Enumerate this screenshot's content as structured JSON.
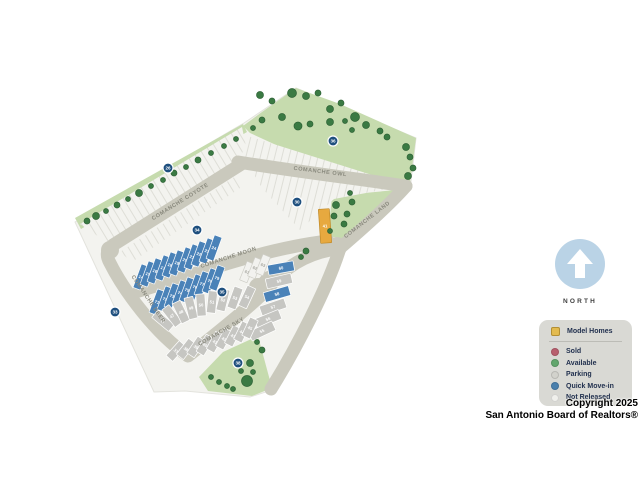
{
  "north": {
    "label": "NORTH"
  },
  "copyright": {
    "line1": "Copyright 2025",
    "line2": "San Antonio Board of Realtors®"
  },
  "legend": {
    "items": [
      {
        "label": "Model Homes",
        "color": "#e3bb4f",
        "shape": "square"
      },
      {
        "label": "Sold",
        "color": "#b85f6e",
        "shape": "circle"
      },
      {
        "label": "Available",
        "color": "#62a66d",
        "shape": "circle"
      },
      {
        "label": "Parking",
        "color": "#d2d2cc",
        "shape": "circle"
      },
      {
        "label": "Quick Move-in",
        "color": "#4a80ad",
        "shape": "circle"
      },
      {
        "label": "Not Released",
        "color": "#f0f0ec",
        "shape": "circle"
      }
    ]
  },
  "map": {
    "road_labels": [
      {
        "text": "COMANCHE OWL",
        "x": 320,
        "y": 173,
        "rot": 7
      },
      {
        "text": "COMANCHE COYOTE",
        "x": 181,
        "y": 203,
        "rot": -32
      },
      {
        "text": "COMANCHE LAND",
        "x": 368,
        "y": 221,
        "rot": -38
      },
      {
        "text": "COMANCHE MOON",
        "x": 229,
        "y": 259,
        "rot": -18
      },
      {
        "text": "COMANCHE SKY",
        "x": 222,
        "y": 333,
        "rot": -30
      },
      {
        "text": "COMANCHE DEER",
        "x": 147,
        "y": 300,
        "rot": 56
      }
    ],
    "lot_colors": {
      "quick": {
        "fill": "#4a82b8",
        "text": "#ffffff",
        "stroke": "#ffffff"
      },
      "gray": {
        "fill": "#c6c6c2",
        "text": "#ffffff",
        "stroke": "#ffffff"
      },
      "white": {
        "fill": "#f2f2ef",
        "text": "#a8a8a2",
        "stroke": "#cfcfc8"
      },
      "model": {
        "fill": "#e7a93f",
        "text": "#ffffff",
        "stroke": "#c08a28"
      }
    },
    "marker_color": "#1e4f7e",
    "tree_color": "#3a7a43",
    "tree_edge": "#2e6236",
    "lots": [
      {
        "n": "14",
        "x": 141,
        "y": 277,
        "w": 8,
        "h": 25,
        "rot": 20,
        "status": "quick"
      },
      {
        "n": "15",
        "x": 148,
        "y": 274,
        "w": 8,
        "h": 25,
        "rot": 20,
        "status": "quick"
      },
      {
        "n": "16",
        "x": 155,
        "y": 271,
        "w": 8,
        "h": 25,
        "rot": 20,
        "status": "quick"
      },
      {
        "n": "17",
        "x": 163,
        "y": 268,
        "w": 8,
        "h": 25,
        "rot": 20,
        "status": "quick"
      },
      {
        "n": "18",
        "x": 170,
        "y": 265,
        "w": 8,
        "h": 25,
        "rot": 20,
        "status": "quick"
      },
      {
        "n": "19",
        "x": 177,
        "y": 263,
        "w": 8,
        "h": 25,
        "rot": 20,
        "status": "quick"
      },
      {
        "n": "20",
        "x": 185,
        "y": 260,
        "w": 8,
        "h": 25,
        "rot": 20,
        "status": "quick"
      },
      {
        "n": "21",
        "x": 192,
        "y": 257,
        "w": 8,
        "h": 25,
        "rot": 20,
        "status": "quick"
      },
      {
        "n": "22",
        "x": 199,
        "y": 254,
        "w": 8,
        "h": 25,
        "rot": 20,
        "status": "quick"
      },
      {
        "n": "23",
        "x": 207,
        "y": 251,
        "w": 8,
        "h": 25,
        "rot": 20,
        "status": "quick"
      },
      {
        "n": "24",
        "x": 214,
        "y": 248,
        "w": 8,
        "h": 25,
        "rot": 20,
        "status": "quick"
      },
      {
        "n": "71",
        "x": 157,
        "y": 302,
        "w": 8,
        "h": 25,
        "rot": 20,
        "status": "quick"
      },
      {
        "n": "72",
        "x": 165,
        "y": 299,
        "w": 8,
        "h": 25,
        "rot": 20,
        "status": "quick"
      },
      {
        "n": "73",
        "x": 172,
        "y": 296,
        "w": 8,
        "h": 25,
        "rot": 20,
        "status": "quick"
      },
      {
        "n": "74",
        "x": 180,
        "y": 293,
        "w": 8,
        "h": 25,
        "rot": 20,
        "status": "quick"
      },
      {
        "n": "75",
        "x": 187,
        "y": 290,
        "w": 8,
        "h": 25,
        "rot": 20,
        "status": "quick"
      },
      {
        "n": "76",
        "x": 195,
        "y": 287,
        "w": 8,
        "h": 25,
        "rot": 20,
        "status": "quick"
      },
      {
        "n": "77",
        "x": 202,
        "y": 284,
        "w": 8,
        "h": 25,
        "rot": 20,
        "status": "quick"
      },
      {
        "n": "78",
        "x": 210,
        "y": 281,
        "w": 8,
        "h": 25,
        "rot": 20,
        "status": "quick"
      },
      {
        "n": "79",
        "x": 217,
        "y": 278,
        "w": 8,
        "h": 25,
        "rot": 20,
        "status": "quick"
      },
      {
        "n": "61",
        "x": 247,
        "y": 272,
        "w": 8,
        "h": 20,
        "rot": 22,
        "status": "white"
      },
      {
        "n": "62",
        "x": 255,
        "y": 268,
        "w": 8,
        "h": 20,
        "rot": 22,
        "status": "white"
      },
      {
        "n": "63",
        "x": 263,
        "y": 265,
        "w": 8,
        "h": 20,
        "rot": 22,
        "status": "white"
      },
      {
        "n": "60",
        "x": 281,
        "y": 268,
        "w": 26,
        "h": 10,
        "rot": -10,
        "status": "quick"
      },
      {
        "n": "59",
        "x": 279,
        "y": 281,
        "w": 26,
        "h": 10,
        "rot": -13,
        "status": "gray"
      },
      {
        "n": "58",
        "x": 277,
        "y": 294,
        "w": 26,
        "h": 10,
        "rot": -16,
        "status": "quick"
      },
      {
        "n": "57",
        "x": 273,
        "y": 307,
        "w": 26,
        "h": 10,
        "rot": -19,
        "status": "gray"
      },
      {
        "n": "56",
        "x": 268,
        "y": 319,
        "w": 26,
        "h": 10,
        "rot": -22,
        "status": "gray"
      },
      {
        "n": "55",
        "x": 262,
        "y": 331,
        "w": 26,
        "h": 10,
        "rot": -25,
        "status": "gray"
      },
      {
        "n": "46",
        "x": 163,
        "y": 321,
        "w": 9,
        "h": 22,
        "rot": -50,
        "status": "gray"
      },
      {
        "n": "47",
        "x": 172,
        "y": 316,
        "w": 9,
        "h": 22,
        "rot": -38,
        "status": "gray"
      },
      {
        "n": "48",
        "x": 181,
        "y": 312,
        "w": 9,
        "h": 22,
        "rot": -26,
        "status": "gray"
      },
      {
        "n": "49",
        "x": 191,
        "y": 308,
        "w": 9,
        "h": 22,
        "rot": -14,
        "status": "gray"
      },
      {
        "n": "50",
        "x": 201,
        "y": 305,
        "w": 9,
        "h": 22,
        "rot": -4,
        "status": "gray"
      },
      {
        "n": "51",
        "x": 212,
        "y": 302,
        "w": 9,
        "h": 22,
        "rot": 6,
        "status": "gray"
      },
      {
        "n": "52",
        "x": 223,
        "y": 300,
        "w": 9,
        "h": 22,
        "rot": 14,
        "status": "gray"
      },
      {
        "n": "53",
        "x": 235,
        "y": 298,
        "w": 9,
        "h": 22,
        "rot": 20,
        "status": "gray"
      },
      {
        "n": "54",
        "x": 247,
        "y": 297,
        "w": 9,
        "h": 22,
        "rot": 25,
        "status": "gray"
      },
      {
        "n": "37",
        "x": 176,
        "y": 351,
        "w": 9,
        "h": 20,
        "rot": 42,
        "status": "gray"
      },
      {
        "n": "38",
        "x": 186,
        "y": 349,
        "w": 9,
        "h": 20,
        "rot": 38,
        "status": "gray"
      },
      {
        "n": "39",
        "x": 196,
        "y": 347,
        "w": 9,
        "h": 20,
        "rot": 34,
        "status": "gray"
      },
      {
        "n": "40",
        "x": 205,
        "y": 345,
        "w": 9,
        "h": 20,
        "rot": 31,
        "status": "gray"
      },
      {
        "n": "41",
        "x": 215,
        "y": 342,
        "w": 9,
        "h": 20,
        "rot": 29,
        "status": "gray"
      },
      {
        "n": "42",
        "x": 224,
        "y": 339,
        "w": 9,
        "h": 20,
        "rot": 28,
        "status": "gray"
      },
      {
        "n": "43",
        "x": 233,
        "y": 336,
        "w": 9,
        "h": 20,
        "rot": 27,
        "status": "gray"
      },
      {
        "n": "44",
        "x": 242,
        "y": 332,
        "w": 9,
        "h": 20,
        "rot": 26,
        "status": "gray"
      },
      {
        "n": "45",
        "x": 250,
        "y": 328,
        "w": 9,
        "h": 20,
        "rot": 25,
        "status": "gray"
      },
      {
        "n": "41",
        "x": 325,
        "y": 226,
        "w": 11,
        "h": 34,
        "rot": -4,
        "status": "model"
      }
    ],
    "markers": [
      {
        "n": "26",
        "x": 168,
        "y": 168
      },
      {
        "n": "36",
        "x": 333,
        "y": 141
      },
      {
        "n": "30",
        "x": 297,
        "y": 202
      },
      {
        "n": "34",
        "x": 197,
        "y": 230
      },
      {
        "n": "35",
        "x": 222,
        "y": 292
      },
      {
        "n": "33",
        "x": 115,
        "y": 312
      },
      {
        "n": "38",
        "x": 238,
        "y": 363
      }
    ],
    "trees": [
      [
        87,
        221,
        3
      ],
      [
        96,
        216,
        3.5
      ],
      [
        106,
        211,
        2.5
      ],
      [
        117,
        205,
        3
      ],
      [
        128,
        199,
        2.5
      ],
      [
        139,
        193,
        3.5
      ],
      [
        151,
        186,
        2.5
      ],
      [
        163,
        180,
        2.5
      ],
      [
        174,
        173,
        3
      ],
      [
        186,
        167,
        2.5
      ],
      [
        198,
        160,
        3
      ],
      [
        211,
        153,
        2.5
      ],
      [
        224,
        146,
        2.5
      ],
      [
        236,
        139,
        2.5
      ],
      [
        260,
        95,
        3.5
      ],
      [
        272,
        101,
        3
      ],
      [
        292,
        93,
        4.5
      ],
      [
        306,
        96,
        3.5
      ],
      [
        318,
        93,
        3
      ],
      [
        330,
        109,
        3.5
      ],
      [
        341,
        103,
        3
      ],
      [
        355,
        117,
        4.5
      ],
      [
        366,
        125,
        3.5
      ],
      [
        330,
        122,
        3.5
      ],
      [
        310,
        124,
        3
      ],
      [
        298,
        126,
        4
      ],
      [
        282,
        117,
        3.5
      ],
      [
        262,
        120,
        3
      ],
      [
        380,
        131,
        3
      ],
      [
        387,
        137,
        3
      ],
      [
        406,
        147,
        3.5
      ],
      [
        410,
        157,
        3
      ],
      [
        413,
        168,
        3
      ],
      [
        408,
        176,
        3.5
      ],
      [
        352,
        130,
        2.5
      ],
      [
        345,
        121,
        2.5
      ],
      [
        253,
        128,
        2.5
      ],
      [
        336,
        205,
        3.5
      ],
      [
        334,
        216,
        3
      ],
      [
        347,
        214,
        3
      ],
      [
        352,
        202,
        3
      ],
      [
        344,
        224,
        3
      ],
      [
        330,
        231,
        2.5
      ],
      [
        350,
        193,
        2.5
      ],
      [
        306,
        251,
        3
      ],
      [
        301,
        257,
        2.5
      ],
      [
        247,
        381,
        5.5
      ],
      [
        250,
        363,
        3.5
      ],
      [
        233,
        389,
        2.5
      ],
      [
        227,
        386,
        2.5
      ],
      [
        219,
        382,
        2.5
      ],
      [
        211,
        377,
        2.5
      ],
      [
        253,
        372,
        2.5
      ],
      [
        262,
        350,
        3
      ],
      [
        257,
        342,
        2.5
      ],
      [
        241,
        371,
        2.5
      ]
    ]
  }
}
